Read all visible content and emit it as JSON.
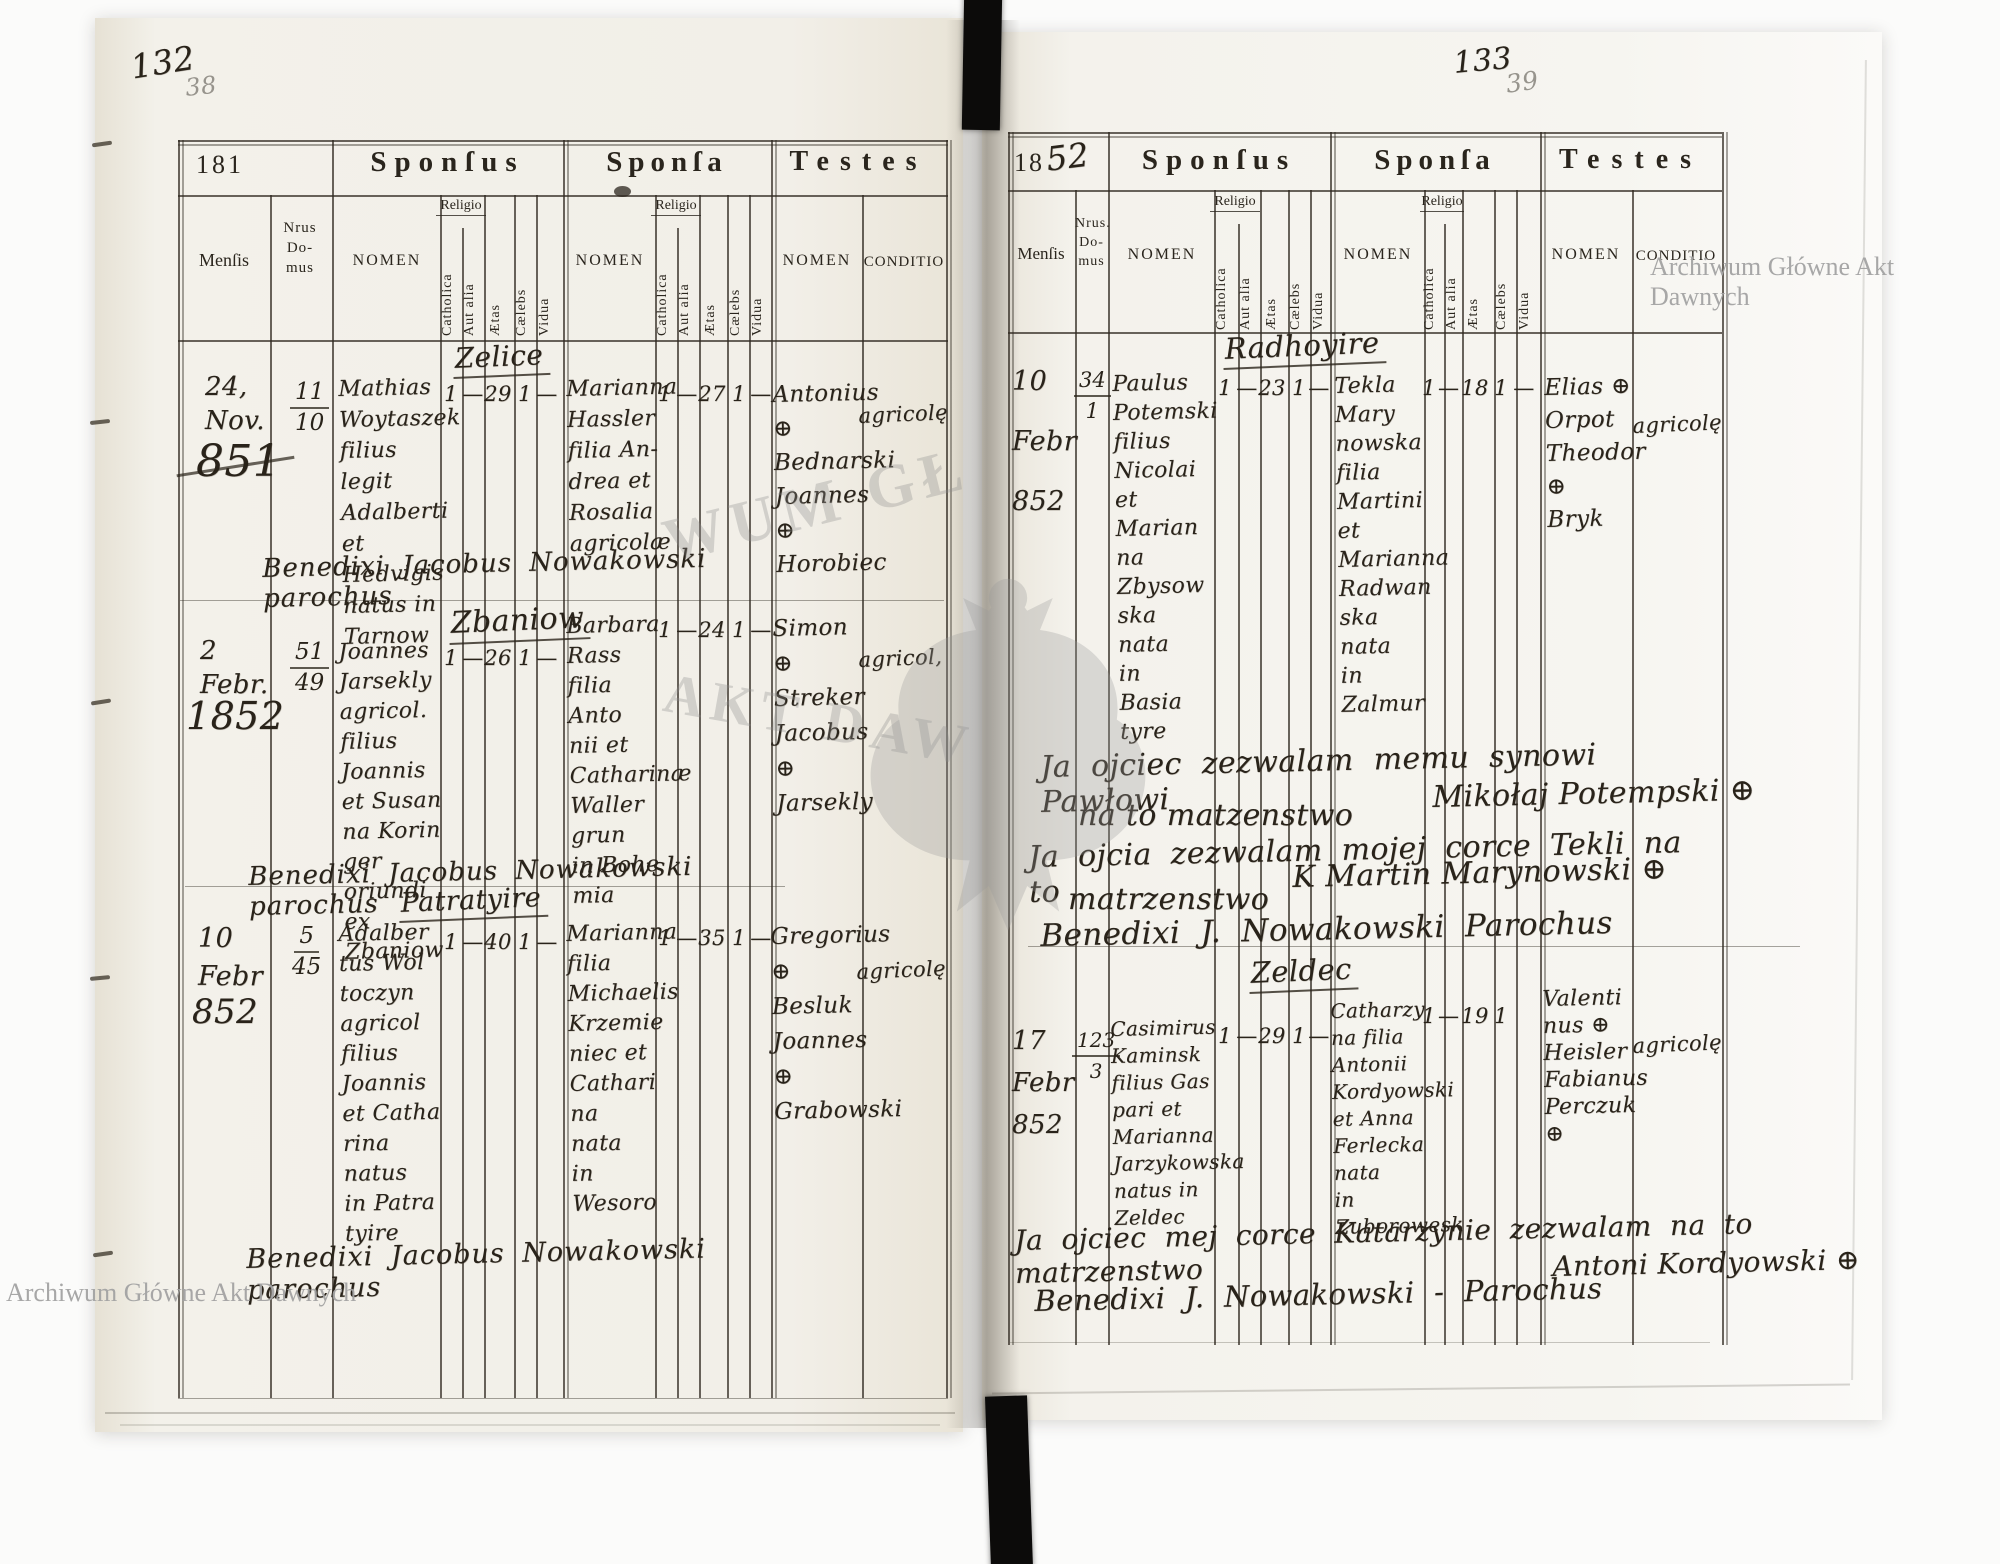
{
  "watermarks": {
    "archive_top_right": "Archiwum Główne Akt Dawnych",
    "archive_bottom_left": "Archiwum Główne Akt Dawnych",
    "emblem_text_top": "WUM GŁ",
    "emblem_text_bottom": "AKT DAW"
  },
  "page_left": {
    "folio_ink": "132",
    "folio_pencil": "38",
    "header": {
      "year": "181",
      "sponsus": "Sponſus",
      "sponsa": "Sponſa",
      "testes": "Testes",
      "mensis": "Menſis",
      "nrus": "Nrus\nDo-\nmus",
      "nomen": "NOMEN",
      "religio": "Religio",
      "catholica": "Catholica",
      "aut_alia": "Aut alia",
      "aetas": "Ætas",
      "caelebs": "Cælebs",
      "vidua": "Vidua",
      "conditio": "CONDITIO"
    },
    "entries": [
      {
        "village": "Zelice",
        "date": "24,\nNov.",
        "year_big": "851",
        "nrus_top": "11",
        "nrus_bottom": "10",
        "sponsus_nomen": "Mathias\nWoytaszek\nfilius legit\nAdalberti\net Hedvigis\nnatus in\nTarnow",
        "sponsus_vals": [
          "1",
          "—",
          "29",
          "1",
          "—"
        ],
        "sponsa_nomen": "Marianna\nHassler\nfilia An-\ndrea et\nRosalia\nagricolæ",
        "sponsa_vals": [
          "1",
          "—",
          "27",
          "1",
          "—"
        ],
        "testes_nomen": "Antonius ⊕\nBednarski\nJoannes ⊕\nHorobiec",
        "testes_conditio": "agricolę",
        "note": "Benedixi Jacobus Nowakowski parochus"
      },
      {
        "village": "Zbaniow",
        "date": "2\nFebr.",
        "year_big": "1852",
        "nrus_top": "51",
        "nrus_bottom": "49",
        "sponsus_nomen": "Joannes\nJarsekly\nagricol.\nfilius\nJoannis\net Susan\nna Korin\nger\noriundi\nex Zbaniow",
        "sponsus_vals": [
          "1",
          "—",
          "26",
          "1",
          "—"
        ],
        "sponsa_nomen": "Barbara\nRass\nfilia Anto\nnii et\nCatharinæ\nWaller\ngrun\nin Bohe\nmia",
        "sponsa_vals": [
          "1",
          "—",
          "24",
          "1",
          "—"
        ],
        "testes_nomen": "Simon ⊕\nStreker\nJacobus ⊕\nJarsekly",
        "testes_conditio": "agricol,",
        "note": "Benedixi Jacobus Nowakowski parochus"
      },
      {
        "village": "Patratyire",
        "date": "10\nFebr",
        "year_big": "852",
        "nrus_top": "5",
        "nrus_bottom": "45",
        "sponsus_nomen": "Adalber\ntus Wol\ntoczyn\nagricol\nfilius\nJoannis\net Catha\nrina\nnatus\nin Patra\ntyire",
        "sponsus_vals": [
          "1",
          "—",
          "40",
          "1",
          "—"
        ],
        "sponsa_nomen": "Marianna\nfilia\nMichaelis\nKrzemie\nniec et\nCathari\nna\nnata\nin Wesoro",
        "sponsa_vals": [
          "1",
          "—",
          "35",
          "1",
          "—"
        ],
        "testes_nomen": "Gregorius ⊕\nBesluk\nJoannes ⊕\nGrabowski",
        "testes_conditio": "agricolę",
        "note": "Benedixi Jacobus Nowakowski parochus"
      }
    ]
  },
  "page_right": {
    "folio_ink": "133",
    "folio_pencil": "39",
    "header": {
      "year_printed": "18",
      "year_written": "52",
      "sponsus": "Sponſus",
      "sponsa": "Sponſa",
      "testes": "Testes",
      "mensis": "Menſis",
      "nrus": "Nrus.\nDo-\nmus",
      "nomen": "NOMEN",
      "religio": "Religio",
      "catholica": "Catholica",
      "aut_alia": "Aut alia",
      "aetas": "Ætas",
      "caelebs": "Cælebs",
      "vidua": "Vidua",
      "conditio": "CONDITIO"
    },
    "entries": [
      {
        "village": "Radhoyire",
        "date": "10\nFebr\n852",
        "nrus_top": "34",
        "nrus_bottom": "1",
        "sponsus_nomen": "Paulus\nPotemski\nfilius\nNicolai\net\nMarian\nna\nZbysow\nska\nnata\nin\nBasia\ntyre",
        "sponsus_vals": [
          "1",
          "—",
          "23",
          "1",
          "—"
        ],
        "sponsa_nomen": "Tekla\nMary\nnowska\nfilia\nMartini\net\nMarianna\nRadwan\nska\nnata\nin\nZalmur",
        "sponsa_vals": [
          "1",
          "—",
          "18",
          "1",
          "—"
        ],
        "testes_nomen": "Elias ⊕\nOrpot\nTheodor ⊕\nBryk",
        "testes_conditio": "agricolę",
        "consent": {
          "l1": "Ja ojciec zezwalam memu synowi Pawłowi",
          "l2": "na to matzenstwo",
          "l2b": "Mikołaj Potempski ⊕",
          "l3": "Ja ojcia zezwalam mojej corce Tekli na to",
          "l4": "matrzenstwo",
          "l4b": "K Martin Marynowski ⊕",
          "l5": "Benedixi J. Nowakowski Parochus"
        }
      },
      {
        "village": "Zeldec",
        "date": "17\nFebr\n852",
        "nrus_top": "123",
        "nrus_bottom": "3",
        "sponsus_nomen": "Casimirus\nKaminsk\nfilius Gas\npari et\nMarianna\nJarzykowska\nnatus in\nZeldec",
        "sponsus_vals": [
          "1",
          "—",
          "29",
          "1",
          "—"
        ],
        "sponsa_nomen": "Catharzy\nna filia\nAntonii\nKordyowski\net Anna\nFerlecka\nnata\nin\nZuborowesk",
        "sponsa_vals": [
          "1",
          "—",
          "19",
          "1",
          ""
        ],
        "testes_nomen": "Valenti\nnus ⊕\nHeisler\nFabianus\nPerczuk ⊕",
        "testes_conditio": "agricolę",
        "consent": {
          "l1": "Ja ojciec mej corce Katarzynie zezwalam na to matrzenstwo",
          "l2": "Antoni Kordyowski ⊕",
          "l3": "Benedixi J. Nowakowski - Parochus"
        }
      }
    ]
  }
}
